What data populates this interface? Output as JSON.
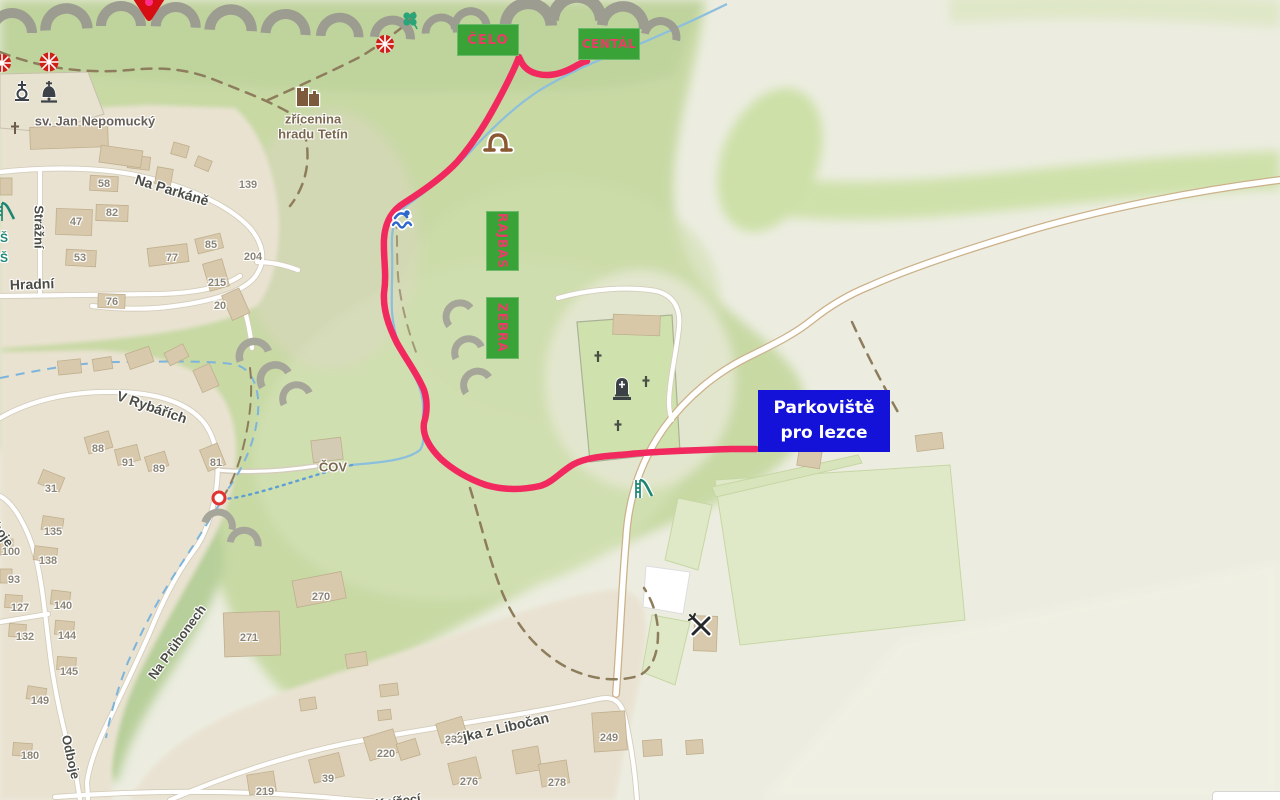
{
  "map": {
    "climbing_labels": {
      "celo": "ČELO",
      "central": "CENTÁL",
      "rajbas": "RAJBAS",
      "zebra": "ZEBRA"
    },
    "parking_label": {
      "line1": "Parkoviště",
      "line2": "pro lezce"
    },
    "poi": {
      "church": "sv. Jan Nepomucký",
      "castle_line1": "zřícenina",
      "castle_line2": "hradu Tetín",
      "cov": "ČOV",
      "school_partial_1": "Š",
      "school_partial_2": "Š"
    },
    "streets": {
      "na_parkane": "Na Parkáně",
      "strazni": "Strážní",
      "hradni": "Hradní",
      "v_rybarich": "V Rybářích",
      "na_pruhonech": "Na Průhonech",
      "odboje": "Odboje",
      "odboje_partial": "Odboje",
      "hajka": "Hájka z Libočan",
      "knizeci": "Knížecí"
    },
    "house_numbers": {
      "58": "58",
      "82": "82",
      "47": "47",
      "53": "53",
      "77": "77",
      "85": "85",
      "204": "204",
      "215": "215",
      "20": "20",
      "76": "76",
      "139": "139",
      "88": "88",
      "91": "91",
      "89": "89",
      "81": "81",
      "31": "31",
      "135": "135",
      "100": "100",
      "138": "138",
      "93": "93",
      "127": "127",
      "140": "140",
      "132": "132",
      "144": "144",
      "145": "145",
      "149": "149",
      "180": "180",
      "270": "270",
      "271": "271",
      "219": "219",
      "39": "39",
      "220": "220",
      "232": "232",
      "276": "276",
      "278": "278",
      "249": "249"
    },
    "colors": {
      "route": "#f1295f",
      "crag_label_bg": "#3aa338",
      "crag_label_text": "#ef3a67",
      "parking_bg": "#1412d8",
      "parking_text": "#ffffff",
      "hill_green": "#c8d9a4",
      "field_green": "#dfe9c8",
      "road_white": "#ffffff",
      "stream_blue": "#8cbede",
      "cliff_gray": "#9d9c90"
    }
  }
}
